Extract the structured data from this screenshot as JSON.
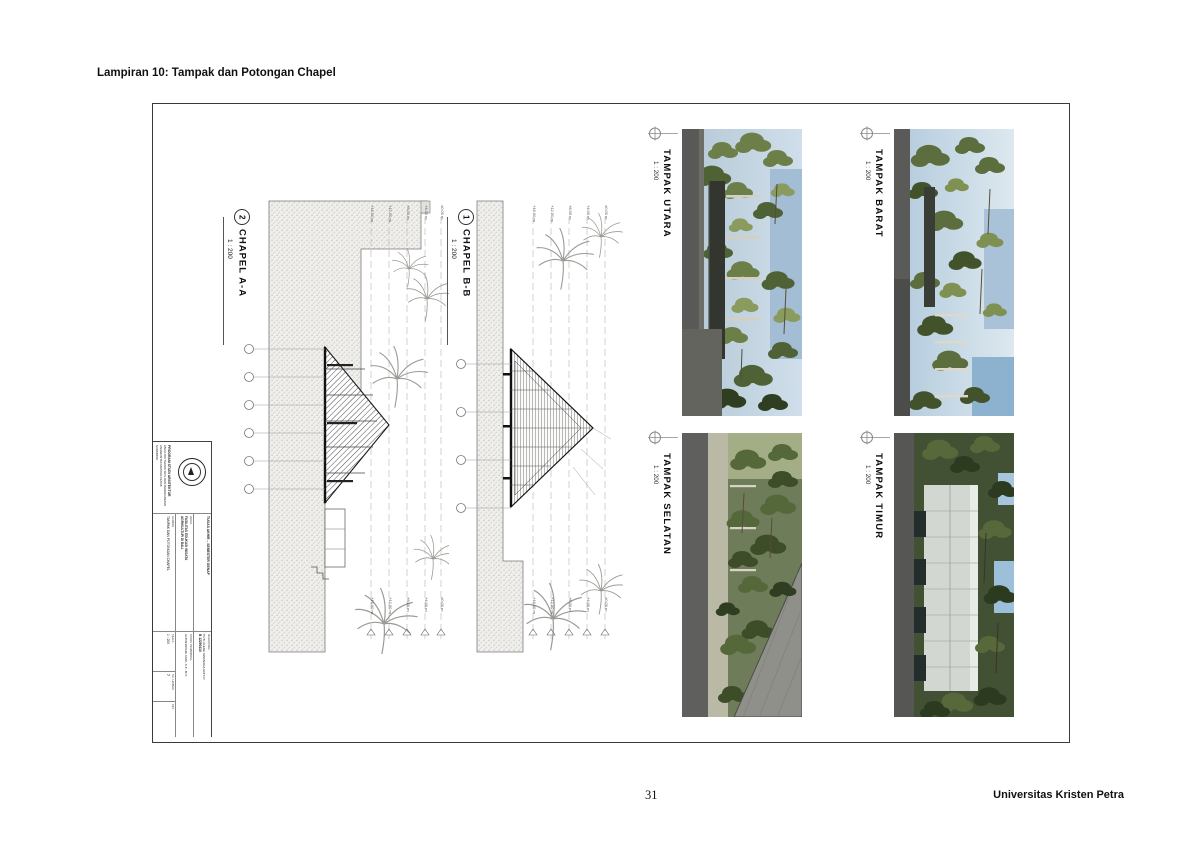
{
  "page": {
    "header": "Lampiran 10: Tampak dan Potongan Chapel",
    "page_number": "31",
    "footer_right": "Universitas Kristen Petra"
  },
  "sections": [
    {
      "num": "2",
      "title": "CHAPEL A-A",
      "scale": "1 : 200"
    },
    {
      "num": "1",
      "title": "CHAPEL B-B",
      "scale": "1 : 200"
    }
  ],
  "renders": [
    {
      "title": "TAMPAK UTARA",
      "scale": "1 : 200"
    },
    {
      "title": "TAMPAK BARAT",
      "scale": "1 : 200"
    },
    {
      "title": "TAMPAK SELATAN",
      "scale": "1 : 200"
    },
    {
      "title": "TAMPAK TIMUR",
      "scale": "1 : 200"
    }
  ],
  "levels": [
    "+16.00 m",
    "+12.00 m",
    "+8.00 m",
    "+4.00 m",
    "±0.00 m"
  ],
  "titleblock": {
    "program": "PROGRAM STUDI ARSITEKTUR",
    "faculty": "FAKULTAS TEKNIK SIPIL DAN PERENCANAAN",
    "university": "UNIVERSITAS KRISTEN PETRA",
    "city": "SURABAYA",
    "project": "TUGAS AKHIR – SEMESTER GENAP",
    "judul_label": "JUDUL",
    "judul_1": "FASILITAS EDUKASI WISATA",
    "judul_2": "AGRIKULTUR DI BALI",
    "gambar_label": "GAMBAR",
    "gambar": "TAMPAK DAN POTONGAN CHAPEL",
    "mahasiswa_label": "MAHASISWA",
    "mahasiswa": "PUTU GEDE SWANAGA ADHI P.",
    "nrp": "B 12290110",
    "dosen_label": "DOSEN PEMBIMBING",
    "dosen": "ALTREROSJE ASRI, S.T., M.T.",
    "skala_label": "SKALA",
    "skala": "1 : 200",
    "lembar_label": "NO. LEMBAR",
    "lembar": "7",
    "ket_label": "KET."
  },
  "palette": {
    "line": "#444444",
    "hatch": "#b9b7b2",
    "sky": "#a9c3d8",
    "foliage_dark": "#3c4d28",
    "foliage": "#6d7f49",
    "foliage_light": "#93a468",
    "concrete_gray": "#5b5b59",
    "roof_dark": "#383c35",
    "chapel_light": "#d3d7d2"
  }
}
